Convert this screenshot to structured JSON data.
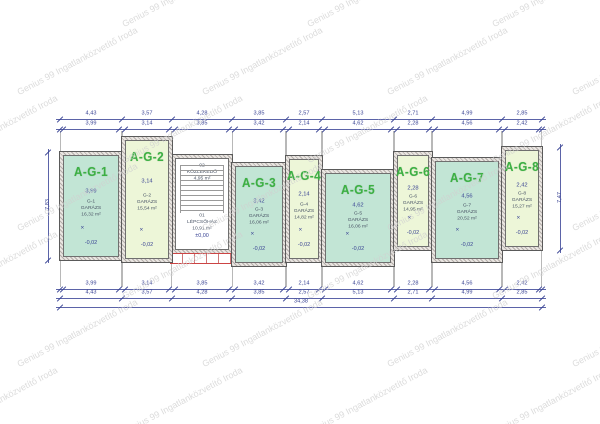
{
  "watermark": {
    "text": "Genius 99 Ingatlanközvetítő Iroda"
  },
  "colors": {
    "teal_fill": "#c2e5d5",
    "light_fill": "#edf6d8",
    "stair_fill": "#ffffff",
    "unit_label_green": "#3cb043",
    "dimension_blue": "#3a4494",
    "room_text": "#4a5566",
    "wall_hatch": "#b4aeaa",
    "steps_red": "#cc4444",
    "watermark_gray": "#d0d0d0"
  },
  "units": [
    {
      "id": "A-G-1",
      "code": "G-1",
      "room": "GARÁZS",
      "area": "16,32 m²",
      "width_dim": "3,99",
      "level": "-0,02",
      "fill": "teal",
      "x": 60,
      "w": 62,
      "top": 152,
      "bottom": 260
    },
    {
      "id": "A-G-2",
      "code": "G-2",
      "room": "GARÁZS",
      "area": "15,54 m²",
      "width_dim": "3,14",
      "level": "-0,02",
      "fill": "light",
      "x": 122,
      "w": 50,
      "top": 137,
      "bottom": 262
    },
    {
      "id": "A-G-3",
      "code": "G-3",
      "room": "GARÁZS",
      "area": "16,06 m²",
      "width_dim": "3,42",
      "level": "-0,02",
      "fill": "teal",
      "x": 232,
      "w": 54,
      "top": 163,
      "bottom": 266
    },
    {
      "id": "A-G-4",
      "code": "G-4",
      "room": "GARÁZS",
      "area": "14,82 m²",
      "width_dim": "2,14",
      "level": "-0,02",
      "fill": "light",
      "x": 286,
      "w": 36,
      "top": 156,
      "bottom": 262
    },
    {
      "id": "A-G-5",
      "code": "G-5",
      "room": "GARÁZS",
      "area": "16,06 m²",
      "width_dim": "4,62",
      "level": "-0,02",
      "fill": "teal",
      "x": 322,
      "w": 72,
      "top": 170,
      "bottom": 266
    },
    {
      "id": "A-G-6",
      "code": "G-6",
      "room": "GARÁZS",
      "area": "14,95 m²",
      "width_dim": "2,28",
      "level": "-0,02",
      "fill": "light",
      "x": 394,
      "w": 38,
      "top": 152,
      "bottom": 250
    },
    {
      "id": "A-G-7",
      "code": "G-7",
      "room": "GARÁZS",
      "area": "20,52 m²",
      "width_dim": "4,56",
      "level": "-0,02",
      "fill": "teal",
      "x": 432,
      "w": 70,
      "top": 158,
      "bottom": 262
    },
    {
      "id": "A-G-8",
      "code": "G-8",
      "room": "GARÁZS",
      "area": "15,27 m²",
      "width_dim": "2,42",
      "level": "-0,02",
      "fill": "light",
      "x": 502,
      "w": 40,
      "top": 147,
      "bottom": 250
    }
  ],
  "stair": {
    "x": 172,
    "w": 60,
    "top": 155,
    "bottom": 253,
    "top_label": {
      "code": "02",
      "name": "KÖZLEKEDŐ",
      "area": "4,95 m²"
    },
    "mid_label": {
      "code": "01",
      "name": "LÉPCSŐHÁZ",
      "area": "10,91 m²"
    },
    "level": "±0,00"
  },
  "entry_steps": {
    "x": 170,
    "w": 64,
    "top": 253,
    "h": 11
  },
  "dims": {
    "x0": 60,
    "top_coarse_y": 119,
    "top_fine_y": 129,
    "bottom_fine_y": 289,
    "bottom_coarse_y": 298,
    "total_y": 307,
    "coarse": [
      {
        "w": 62,
        "v": "4,43"
      },
      {
        "w": 50,
        "v": "3,57"
      },
      {
        "w": 60,
        "v": "4,28"
      },
      {
        "w": 54,
        "v": "3,85"
      },
      {
        "w": 36,
        "v": "2,57"
      },
      {
        "w": 72,
        "v": "5,13"
      },
      {
        "w": 38,
        "v": "2,71"
      },
      {
        "w": 70,
        "v": "4,99"
      },
      {
        "w": 40,
        "v": "2,85"
      }
    ],
    "fine": [
      {
        "w": 3,
        "v": "0,22"
      },
      {
        "w": 56,
        "v": "3,99"
      },
      {
        "w": 6,
        "v": "0,44"
      },
      {
        "w": 44,
        "v": "3,14"
      },
      {
        "w": 6,
        "v": "0,44"
      },
      {
        "w": 54,
        "v": "3,85"
      },
      {
        "w": 6,
        "v": "0,44"
      },
      {
        "w": 48,
        "v": "3,42"
      },
      {
        "w": 6,
        "v": "0,44"
      },
      {
        "w": 30,
        "v": "2,14"
      },
      {
        "w": 6,
        "v": "0,44"
      },
      {
        "w": 66,
        "v": "4,62"
      },
      {
        "w": 6,
        "v": "0,44"
      },
      {
        "w": 32,
        "v": "2,28"
      },
      {
        "w": 6,
        "v": "0,44"
      },
      {
        "w": 64,
        "v": "4,56"
      },
      {
        "w": 6,
        "v": "0,44"
      },
      {
        "w": 34,
        "v": "2,42"
      },
      {
        "w": 3,
        "v": "0,22"
      }
    ],
    "total": "34,38",
    "left_vertical": {
      "x": 48,
      "y1": 152,
      "y2": 260,
      "v": "7,83"
    },
    "right_vertical": {
      "x": 560,
      "y1": 147,
      "y2": 250,
      "v": "7,47"
    }
  }
}
